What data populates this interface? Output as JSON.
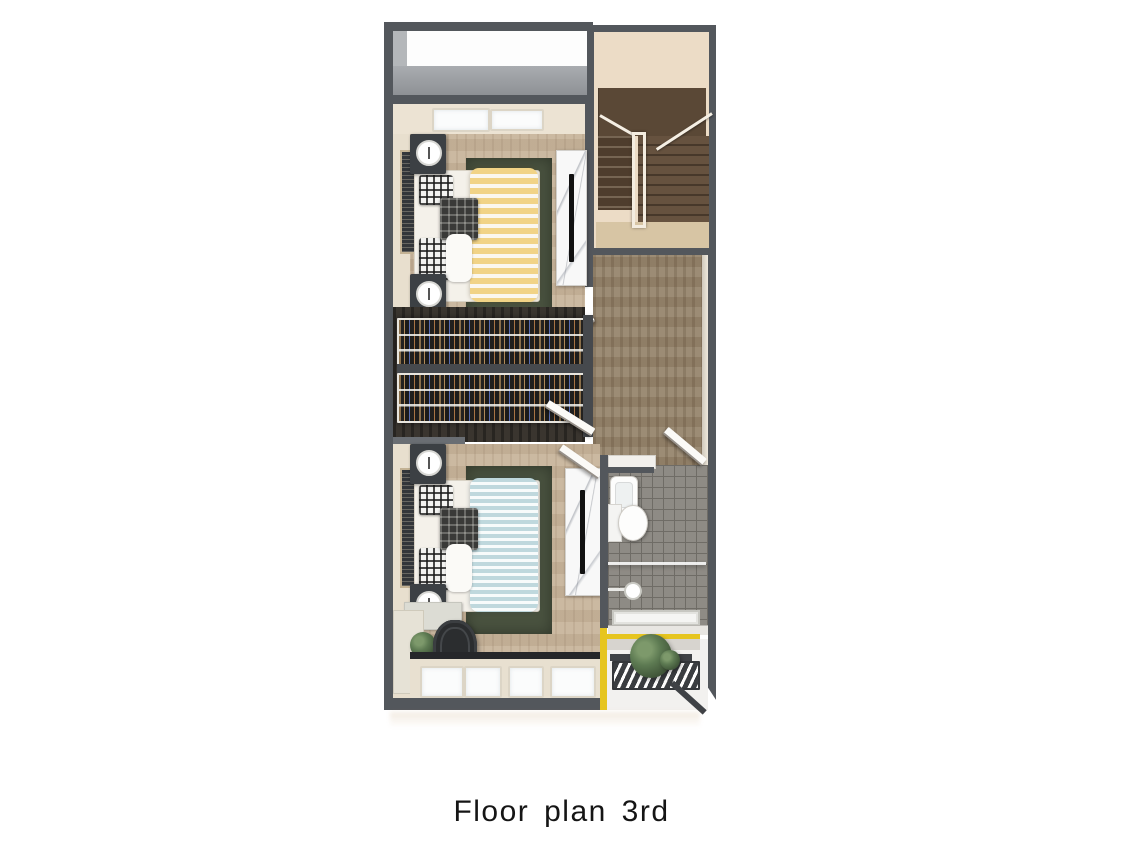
{
  "caption": {
    "text": "Floor plan 3rd"
  },
  "palette": {
    "wall": "#53575c",
    "bedroom_floor": "#c8b59c",
    "hall_floor": "#97866e",
    "rug": "#49523f",
    "bath_tile": "#8e8b85",
    "stair_wood": "#5d4a38",
    "stair_wall": "#ecdcc6",
    "balcony_accent_yellow": "#e6c51f",
    "duvet_yellow": "#f1d386",
    "duvet_blue": "#bfd8dd",
    "marble": "#f8f8f8",
    "background": "#ffffff"
  },
  "objects": [
    "balcony-void",
    "stairwell",
    "bedroom-top",
    "bedroom-bottom",
    "walk-in-closet",
    "hallway",
    "bathroom",
    "rear-balcony",
    "bed",
    "nightstand",
    "clock",
    "rug",
    "tv-cabinet",
    "tv",
    "wardrobe-rack",
    "desk",
    "office-chair",
    "plant",
    "sink",
    "toilet",
    "shower-head",
    "shower-drain",
    "door",
    "window"
  ]
}
